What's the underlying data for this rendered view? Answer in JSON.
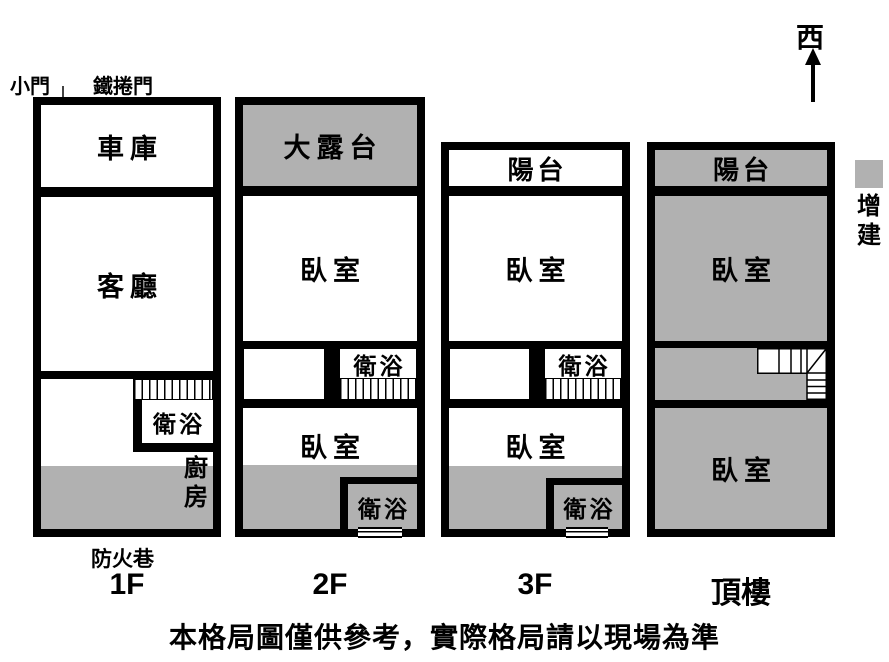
{
  "title_labels": {
    "small_door": "小門",
    "roller_door": "鐵捲門",
    "fire_lane": "防火巷"
  },
  "compass": {
    "label": "西"
  },
  "legend": {
    "label": "增建",
    "color": "#b1b1b1"
  },
  "floors": [
    {
      "label": "1F",
      "rooms": {
        "garage": "車庫",
        "living_room": "客廳",
        "bathroom": "衛浴",
        "kitchen": "廚房"
      }
    },
    {
      "label": "2F",
      "rooms": {
        "terrace": "大露台",
        "bedroom_front": "臥室",
        "bathroom_mid": "衛浴",
        "bedroom_rear": "臥室",
        "bathroom_rear": "衛浴"
      }
    },
    {
      "label": "3F",
      "rooms": {
        "balcony": "陽台",
        "bedroom_front": "臥室",
        "bathroom_mid": "衛浴",
        "bedroom_rear": "臥室",
        "bathroom_rear": "衛浴"
      }
    },
    {
      "label": "頂樓",
      "rooms": {
        "balcony": "陽台",
        "bedroom_front": "臥室",
        "bedroom_rear": "臥室"
      }
    }
  ],
  "disclaimer": "本格局圖僅供參考，實際格局請以現場為準",
  "colors": {
    "wall": "#000000",
    "addition_gray": "#b1b1b1",
    "background": "#ffffff"
  }
}
